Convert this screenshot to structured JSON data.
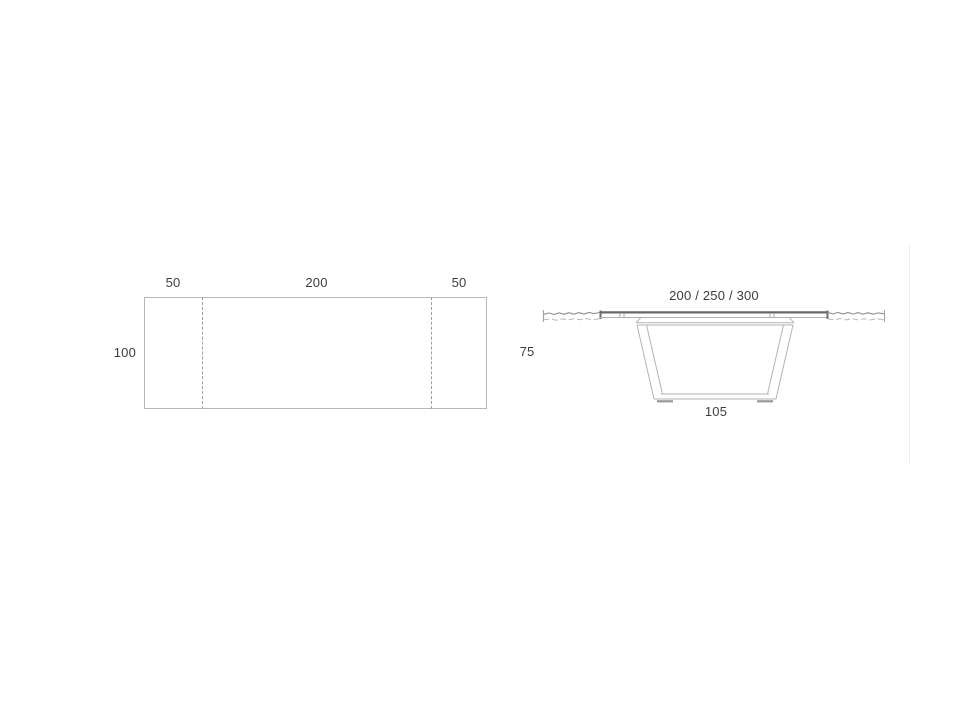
{
  "colors": {
    "background": "#ffffff",
    "line_light": "#b7b7b7",
    "line_mid": "#9e9e9e",
    "line_dark": "#686868",
    "text": "#3d3d3d"
  },
  "top_view": {
    "dim_left_leaf": "50",
    "dim_center": "200",
    "dim_right_leaf": "50",
    "dim_depth": "100"
  },
  "side_view": {
    "dim_length_options": "200 / 250 / 300",
    "dim_height": "75",
    "dim_base_width": "105"
  }
}
